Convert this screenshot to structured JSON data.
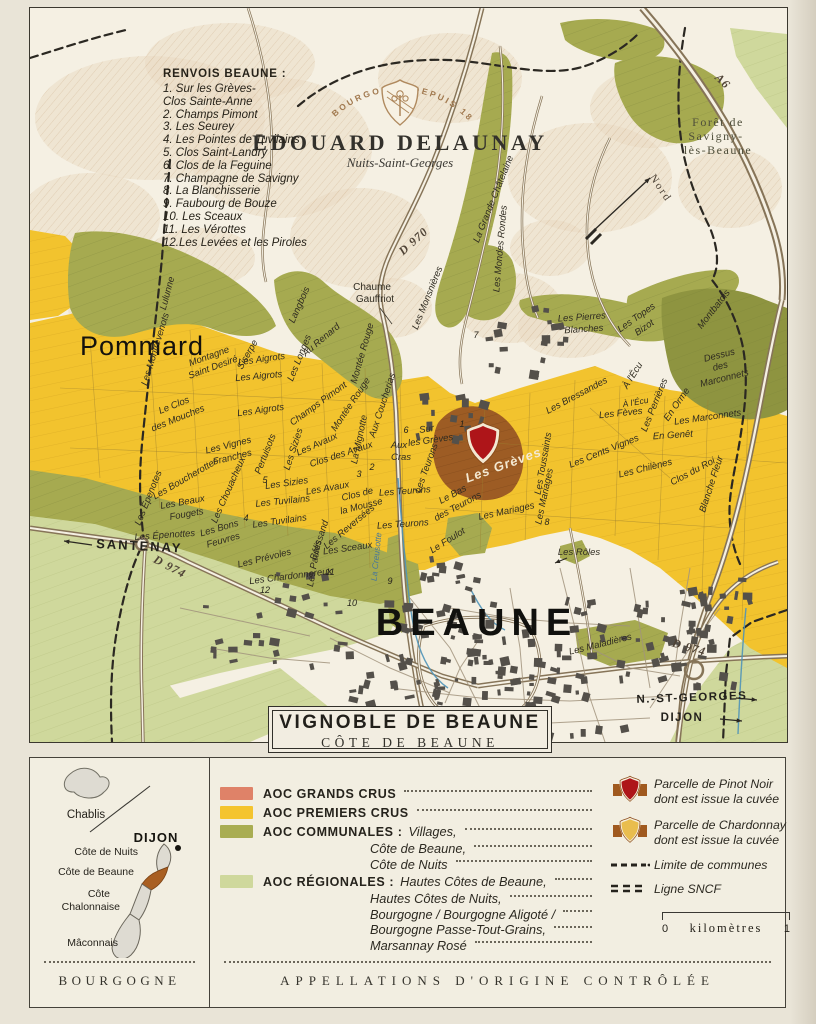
{
  "brand": {
    "arc": "EN BOURGOGNE DEPUIS 1893",
    "name": "EDOUARD DELAUNAY",
    "sub": "Nuits-Saint-Georges"
  },
  "renvois": {
    "title": "RENVOIS BEAUNE :",
    "lines": [
      "1. Sur les Grèves-",
      "Clos Sainte-Anne",
      "2. Champs Pimont",
      "3. Les Seurey",
      "4. Les Pointes de Tuvilains",
      "5. Clos Saint-Landry",
      "6. Clos de la Feguine",
      "7. Champagne de Savigny",
      "8. La Blanchisserie",
      "9. Faubourg de Bouze",
      "10. Les Sceaux",
      "11. Les Vérottes",
      "12.Les Levées et les Piroles"
    ]
  },
  "map": {
    "labels": [
      {
        "t": "Pommard",
        "x": 50,
        "y": 347,
        "c": "town-lg",
        "a": "start"
      },
      {
        "t": "BEAUNE",
        "x": 447,
        "y": 627,
        "c": "city"
      },
      {
        "t": "SANTENAY",
        "x": 66,
        "y": 540,
        "c": "town-sm",
        "a": "start",
        "r": 3
      },
      {
        "t": "N.-ST-GEORGES",
        "x": 662,
        "y": 693,
        "c": "town-xs",
        "r": -2
      },
      {
        "t": "DIJON",
        "x": 652,
        "y": 713,
        "c": "town-xs"
      },
      {
        "t": "D 970",
        "x": 386,
        "y": 236,
        "r": -42,
        "c": "road"
      },
      {
        "t": "D 974",
        "x": 138,
        "y": 562,
        "r": 28,
        "c": "road"
      },
      {
        "t": "D 974",
        "x": 658,
        "y": 643,
        "r": 16,
        "c": "road"
      },
      {
        "t": "A6",
        "x": 690,
        "y": 76,
        "r": 44,
        "c": "road"
      },
      {
        "t": "Nord",
        "x": 628,
        "y": 182,
        "r": 56,
        "c": "compass"
      },
      {
        "t": "Forêt de",
        "x": 688,
        "y": 118,
        "c": "forest"
      },
      {
        "t": "Savigny-",
        "x": 686,
        "y": 132,
        "c": "forest"
      },
      {
        "t": "lès-Beaune",
        "x": 688,
        "y": 146,
        "c": "forest"
      },
      {
        "t": "Chaume",
        "x": 342,
        "y": 282,
        "c": "vg"
      },
      {
        "t": "Gauffriot",
        "x": 345,
        "y": 294,
        "c": "vg"
      },
      {
        "t": "Lulunne",
        "x": 140,
        "y": 286,
        "r": -75
      },
      {
        "t": "Les Montrevenots",
        "x": 128,
        "y": 342,
        "r": -73
      },
      {
        "t": "Montagne",
        "x": 180,
        "y": 351,
        "r": -20
      },
      {
        "t": "Saint Desiré",
        "x": 184,
        "y": 362,
        "r": -20
      },
      {
        "t": "Siserpe",
        "x": 220,
        "y": 348,
        "r": -60
      },
      {
        "t": "Les Aigrots",
        "x": 232,
        "y": 354,
        "r": -8
      },
      {
        "t": "Les Aigrots",
        "x": 229,
        "y": 371,
        "r": -5
      },
      {
        "t": "Les Aigrots",
        "x": 231,
        "y": 405,
        "r": -8
      },
      {
        "t": "Le Clos",
        "x": 145,
        "y": 400,
        "r": -22
      },
      {
        "t": "des Mouches",
        "x": 149,
        "y": 413,
        "r": -22
      },
      {
        "t": "Les Vignes",
        "x": 199,
        "y": 440,
        "r": -14
      },
      {
        "t": "Franches",
        "x": 203,
        "y": 452,
        "r": -14
      },
      {
        "t": "Pertuisots",
        "x": 238,
        "y": 447,
        "r": -68
      },
      {
        "t": "Les Boucherottes",
        "x": 157,
        "y": 473,
        "r": -30
      },
      {
        "t": "Les Épenotes",
        "x": 121,
        "y": 491,
        "r": -68
      },
      {
        "t": "Les Beaux",
        "x": 153,
        "y": 497,
        "r": -10
      },
      {
        "t": "Fougets",
        "x": 157,
        "y": 509,
        "r": -10
      },
      {
        "t": "Les Chouacheux",
        "x": 201,
        "y": 483,
        "r": -66
      },
      {
        "t": "Les Sizies",
        "x": 266,
        "y": 442,
        "r": -72
      },
      {
        "t": "Les Sizies",
        "x": 257,
        "y": 478,
        "r": -8
      },
      {
        "t": "Les Tuvilains",
        "x": 253,
        "y": 496,
        "r": -6
      },
      {
        "t": "Les Tuvilains",
        "x": 250,
        "y": 516,
        "r": -8
      },
      {
        "t": "Les Épenottes",
        "x": 135,
        "y": 530,
        "r": -4
      },
      {
        "t": "Les Bons",
        "x": 190,
        "y": 523,
        "r": -16
      },
      {
        "t": "Feuvres",
        "x": 194,
        "y": 535,
        "r": -16
      },
      {
        "t": "Les Prévoles",
        "x": 235,
        "y": 553,
        "r": -14
      },
      {
        "t": "Les Chardonnereux",
        "x": 261,
        "y": 571,
        "r": -7
      },
      {
        "t": "Bélissand",
        "x": 292,
        "y": 533,
        "r": -72
      },
      {
        "t": "Les Paules",
        "x": 287,
        "y": 556,
        "r": -80
      },
      {
        "t": "Les Avaux",
        "x": 288,
        "y": 439,
        "r": -24
      },
      {
        "t": "Clos des Avaux",
        "x": 312,
        "y": 449,
        "r": -18
      },
      {
        "t": "Les Avaux",
        "x": 298,
        "y": 483,
        "r": -10
      },
      {
        "t": "Clos de",
        "x": 328,
        "y": 489,
        "r": -14
      },
      {
        "t": "la Mousse",
        "x": 332,
        "y": 501,
        "r": -14
      },
      {
        "t": "Les Reversées",
        "x": 321,
        "y": 521,
        "r": -40
      },
      {
        "t": "Les Sceaux",
        "x": 318,
        "y": 543,
        "r": -8
      },
      {
        "t": "Champs Pimont",
        "x": 290,
        "y": 398,
        "r": -36
      },
      {
        "t": "Langbois",
        "x": 272,
        "y": 298,
        "r": -66
      },
      {
        "t": "Au Renard",
        "x": 293,
        "y": 334,
        "r": -40
      },
      {
        "t": "Les Longes",
        "x": 272,
        "y": 351,
        "r": -68
      },
      {
        "t": "Montée Rouge",
        "x": 335,
        "y": 346,
        "r": -74
      },
      {
        "t": "Montée Rouge",
        "x": 323,
        "y": 398,
        "r": -56
      },
      {
        "t": "La Mignotte",
        "x": 332,
        "y": 432,
        "r": -78
      },
      {
        "t": "Aux Coucherias",
        "x": 355,
        "y": 398,
        "r": -72
      },
      {
        "t": "Les Monsnières",
        "x": 400,
        "y": 291,
        "r": -68
      },
      {
        "t": "La Grande Châtelaine",
        "x": 466,
        "y": 192,
        "r": -68
      },
      {
        "t": "Les Mondes Rondes",
        "x": 473,
        "y": 241,
        "r": -85
      },
      {
        "t": "Les Pierres",
        "x": 552,
        "y": 312,
        "r": -4
      },
      {
        "t": "Blanches",
        "x": 554,
        "y": 324,
        "r": -4
      },
      {
        "t": "Les Topes",
        "x": 608,
        "y": 312,
        "r": -35
      },
      {
        "t": "Bizot",
        "x": 616,
        "y": 322,
        "r": -35
      },
      {
        "t": "Montbatois",
        "x": 686,
        "y": 303,
        "r": -52
      },
      {
        "t": "Dessus",
        "x": 690,
        "y": 350,
        "r": -14
      },
      {
        "t": "des",
        "x": 691,
        "y": 361,
        "r": -14
      },
      {
        "t": "Marconnets",
        "x": 695,
        "y": 373,
        "r": -14
      },
      {
        "t": "À l'Écu",
        "x": 605,
        "y": 369,
        "r": -58
      },
      {
        "t": "À l'Écu",
        "x": 606,
        "y": 397,
        "r": -10,
        "s": 8.5
      },
      {
        "t": "Les Perrières",
        "x": 627,
        "y": 398,
        "r": -68
      },
      {
        "t": "En Orme",
        "x": 649,
        "y": 398,
        "r": -55
      },
      {
        "t": "Les Fèves",
        "x": 591,
        "y": 408,
        "r": -6
      },
      {
        "t": "Les Marconnets",
        "x": 678,
        "y": 412,
        "r": -8
      },
      {
        "t": "En Genêt",
        "x": 643,
        "y": 430,
        "r": -4
      },
      {
        "t": "Les Cents Vignes",
        "x": 575,
        "y": 446,
        "r": -22
      },
      {
        "t": "Les Chilènes",
        "x": 616,
        "y": 463,
        "r": -14
      },
      {
        "t": "Clos du Roi",
        "x": 664,
        "y": 466,
        "r": -28
      },
      {
        "t": "Blanche Fleur",
        "x": 684,
        "y": 477,
        "r": -72
      },
      {
        "t": "Les Bressandes",
        "x": 548,
        "y": 390,
        "r": -28
      },
      {
        "t": "Sur",
        "x": 397,
        "y": 424,
        "r": -8
      },
      {
        "t": "les Grèves",
        "x": 401,
        "y": 435,
        "r": -8
      },
      {
        "t": "Aux",
        "x": 369,
        "y": 440
      },
      {
        "t": "Cras",
        "x": 371,
        "y": 452
      },
      {
        "t": "Les Teurons",
        "x": 399,
        "y": 461,
        "r": -70
      },
      {
        "t": "Les Grèves",
        "x": 475,
        "y": 461,
        "r": -20,
        "c": "vy2"
      },
      {
        "t": "Les Toussaints",
        "x": 516,
        "y": 456,
        "r": -80
      },
      {
        "t": "Les Teurons",
        "x": 375,
        "y": 486,
        "r": -4
      },
      {
        "t": "Le Bas",
        "x": 424,
        "y": 489,
        "r": -28
      },
      {
        "t": "des Teurons",
        "x": 429,
        "y": 501,
        "r": -28
      },
      {
        "t": "Les Mariages",
        "x": 477,
        "y": 506,
        "r": -12
      },
      {
        "t": "Les Mariages",
        "x": 517,
        "y": 489,
        "r": -78
      },
      {
        "t": "Les Teurons",
        "x": 373,
        "y": 519,
        "r": -4
      },
      {
        "t": "Le Foulot",
        "x": 419,
        "y": 535,
        "r": -32
      },
      {
        "t": "Les Rôles",
        "x": 549,
        "y": 547
      },
      {
        "t": "Les Maladières",
        "x": 571,
        "y": 639,
        "r": -14
      },
      {
        "t": "La Creusotte",
        "x": 349,
        "y": 549,
        "r": -84,
        "c": "stream"
      },
      {
        "t": "1",
        "x": 432,
        "y": 419,
        "c": "num"
      },
      {
        "t": "2",
        "x": 342,
        "y": 462,
        "c": "num"
      },
      {
        "t": "3",
        "x": 329,
        "y": 469,
        "c": "num"
      },
      {
        "t": "4",
        "x": 216,
        "y": 513,
        "c": "num"
      },
      {
        "t": "5",
        "x": 235,
        "y": 475,
        "c": "num"
      },
      {
        "t": "6",
        "x": 376,
        "y": 425,
        "c": "num"
      },
      {
        "t": "7",
        "x": 446,
        "y": 330,
        "c": "num"
      },
      {
        "t": "8",
        "x": 517,
        "y": 517,
        "c": "num"
      },
      {
        "t": "9",
        "x": 360,
        "y": 576,
        "c": "num"
      },
      {
        "t": "10",
        "x": 322,
        "y": 598,
        "c": "num"
      },
      {
        "t": "11",
        "x": 300,
        "y": 567,
        "c": "num"
      },
      {
        "t": "12",
        "x": 235,
        "y": 585,
        "c": "num"
      }
    ]
  },
  "cartouche": {
    "title": "VIGNOBLE DE BEAUNE",
    "subtitle": "CÔTE DE BEAUNE"
  },
  "legend": {
    "classes": [
      {
        "swatch": "#df8268",
        "label": "AOC GRANDS CRUS",
        "sub": []
      },
      {
        "swatch": "#f4c42e",
        "label": "AOC PREMIERS CRUS",
        "sub": []
      },
      {
        "swatch": "#a9ad52",
        "label": "AOC COMMUNALES :",
        "sub": [
          "Villages,",
          "Côte de Beaune,",
          "Côte de Nuits"
        ]
      },
      {
        "swatch": "#cfd89c",
        "label": "AOC RÉGIONALES :",
        "sub": [
          "Hautes Côtes de Beaune,",
          "Hautes Côtes de Nuits,",
          "Bourgogne / Bourgogne Aligoté /",
          "Bourgogne Passe-Tout-Grains,",
          "Marsannay Rosé"
        ]
      }
    ],
    "symbols": [
      {
        "icon": "crest-pinot",
        "lines": [
          "Parcelle de Pinot Noir",
          "dont est issue la cuvée"
        ]
      },
      {
        "icon": "crest-chardonnay",
        "lines": [
          "Parcelle de Chardonnay",
          "dont est issue la cuvée"
        ]
      },
      {
        "icon": "commune-boundary",
        "lines": [
          "Limite de communes"
        ]
      },
      {
        "icon": "sncf-line",
        "lines": [
          "Ligne SNCF"
        ]
      }
    ],
    "scale": {
      "start": "0",
      "label": "kilomètres",
      "end": "1"
    }
  },
  "inset": {
    "chablis": "Chablis",
    "dijon": "DIJON",
    "regions": [
      "Côte de Nuits",
      "Côte de Beaune",
      "Côte",
      "Chalonnaise",
      "Mâconnais"
    ],
    "footer": "BOURGOGNE"
  },
  "footer": {
    "aoc": "APPELLATIONS D'ORIGINE CONTRÔLÉE"
  },
  "colors": {
    "grands_crus": "#df8268",
    "premiers_crus": "#f4c42e",
    "communales": "#a9ad52",
    "regionales": "#cfd89c",
    "pinot_parcel": "#ae1519",
    "chardonnay_parcel": "#e9bd4e"
  }
}
